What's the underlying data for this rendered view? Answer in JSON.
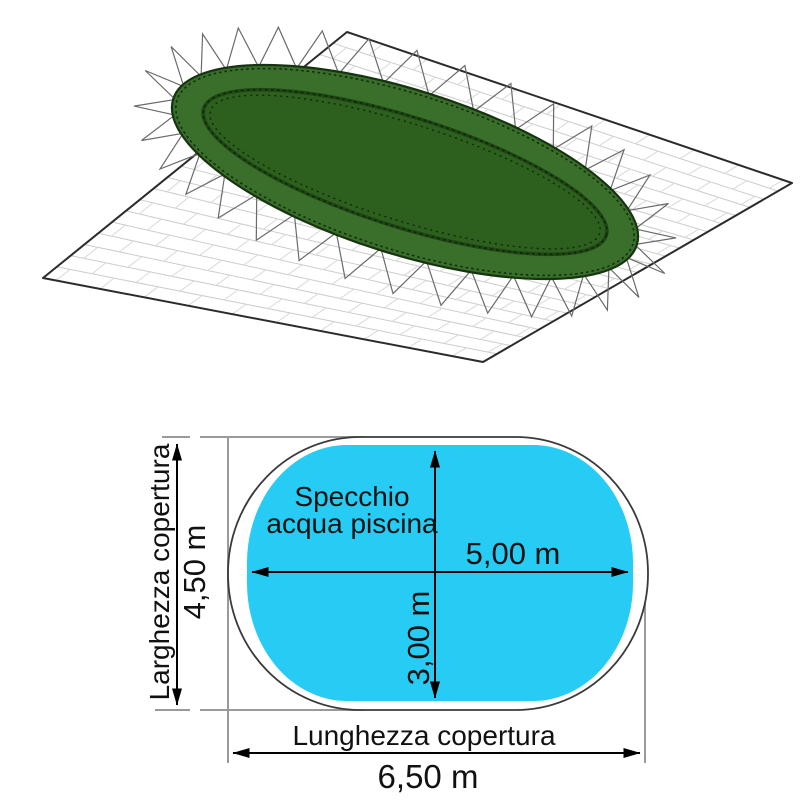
{
  "illustration": {
    "name": "3D view of green oval pool cover tensioned with elastic over paving",
    "colors": {
      "cover_rim": "#3a6f2b",
      "cover_center": "#2d5f1e",
      "cover_seam": "#0f2a0a",
      "cover_edge": "#16340f",
      "ground_outline": "#2b2b2b",
      "brick_line": "#cccccc",
      "brick_joint": "#d9d9d9",
      "spike_line": "#6b6b6b"
    }
  },
  "diagram": {
    "pool_surface_label": [
      "Specchio",
      "acqua piscina"
    ],
    "pool_length_value": "5,00 m",
    "pool_width_value": "3,00 m",
    "cover_width_label": "Larghezza copertura",
    "cover_width_value": "4,50 m",
    "cover_length_label": "Lunghezza copertura",
    "cover_length_value": "6,50 m",
    "colors": {
      "water": "#27ccf5",
      "cover_outline": "#3a3a3a",
      "dimension": "#000000",
      "extension": "#9a9a9a",
      "text": "#111111"
    }
  }
}
